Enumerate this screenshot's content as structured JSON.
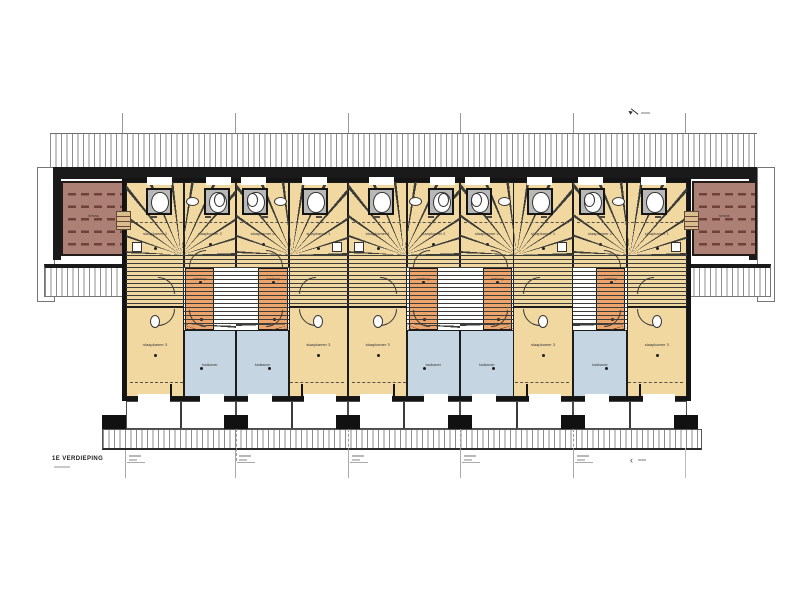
{
  "drawing": {
    "floor_label": "1E VERDIEPING",
    "unit_count": 5,
    "room_labels": {
      "bedroom_front": "slaapkamer 1",
      "bedroom_side": "slaapkamer 2",
      "bedroom_rear": "slaapkamer 3",
      "bathroom": "badkamer",
      "landing": "overloop",
      "terrace": "terras"
    },
    "colors": {
      "bedroom_fill": "#f1d7a0",
      "landing_fill": "#eda46b",
      "bathroom_fill": "#c5d5e1",
      "terrace_fill": "#ac8074",
      "wall": "#161616"
    }
  }
}
